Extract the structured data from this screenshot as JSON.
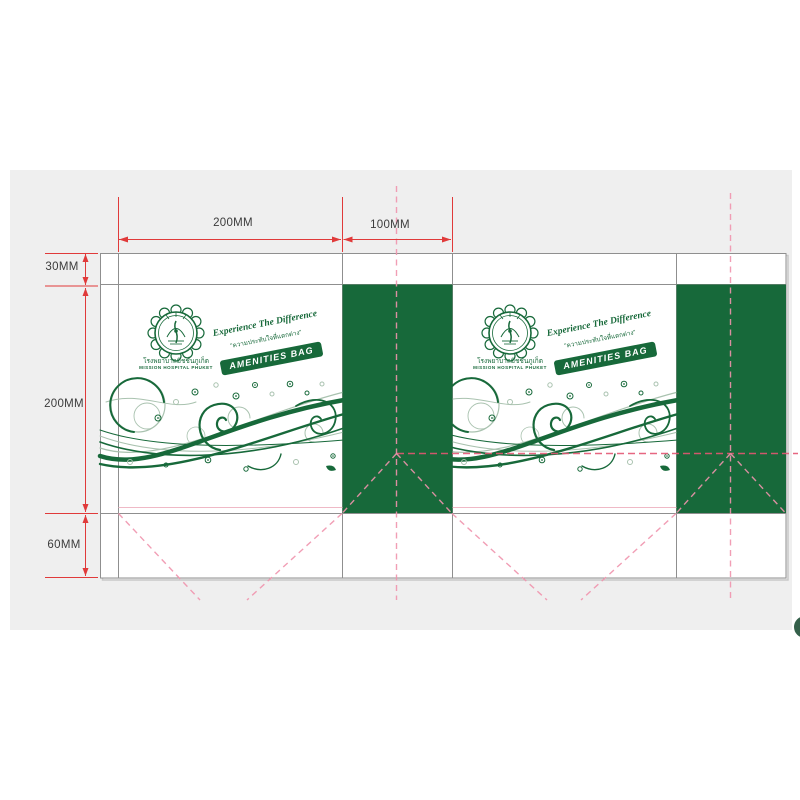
{
  "dimensions": {
    "panel_width": "200MM",
    "gusset_width": "100MM",
    "top_flap_height": "30MM",
    "panel_height": "200MM",
    "bottom_flap_height": "60MM"
  },
  "branding": {
    "tagline_script": "Experience The Difference",
    "tagline_thai": "\"ความประทับใจที่แตกต่าง\"",
    "badge_label": "AMENITIES BAG",
    "hospital_name_thai": "โรงพยาบาลมิชชั่นภูเก็ต",
    "hospital_name_english": "MISSION HOSPITAL PHUKET",
    "logo_icon": "scalloped-seal-emblem"
  },
  "colors": {
    "green": "#17693A",
    "swirl_light": "#A9C2AF",
    "dash_pink": "#F093AD",
    "dash_red": "#E35673",
    "dim_red": "#E03A3A",
    "line_gray": "#8F8F8F",
    "band_gray": "#EFEFEF",
    "crease_pink": "#EFB9C6",
    "text_dark": "#3C3C3C",
    "corner_green": "#34604A"
  }
}
